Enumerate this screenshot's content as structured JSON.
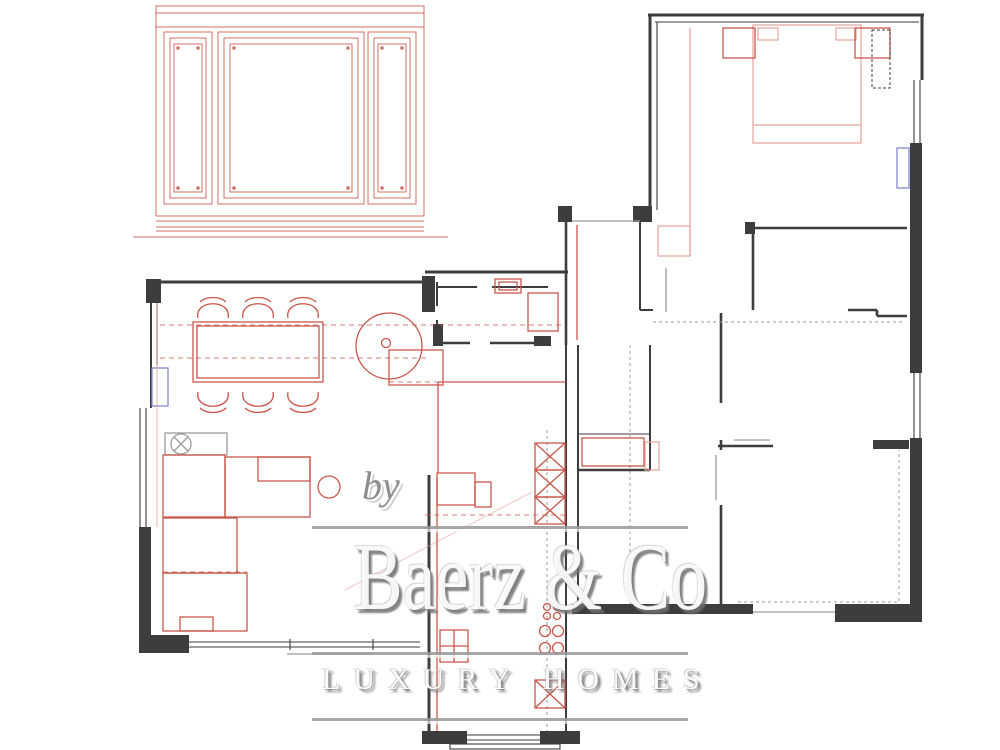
{
  "watermark": {
    "prefix": "by",
    "brand": "Baerz & Co",
    "tagline": "LUXURY HOMES"
  },
  "colors": {
    "background": "#ffffff",
    "wall": "#3d3d3d",
    "furniture": "#c9564a",
    "furniture_light": "#e4a49c",
    "window": "#8289cb",
    "detail_gray": "#9b9b9b",
    "watermark": "#8d8d8d"
  },
  "drawing": {
    "type": "floor-plan",
    "symbols": [
      "wall-paneling-elevation",
      "dining-table",
      "dining-chairs",
      "sofa-sectional",
      "side-table",
      "ceiling-light",
      "spiral-column",
      "bathroom-sink",
      "shower",
      "kitchen-sink",
      "stove-burners",
      "tall-cabinet-x",
      "double-bed",
      "nightstands",
      "wardrobe",
      "window-markers",
      "door-openings"
    ]
  }
}
